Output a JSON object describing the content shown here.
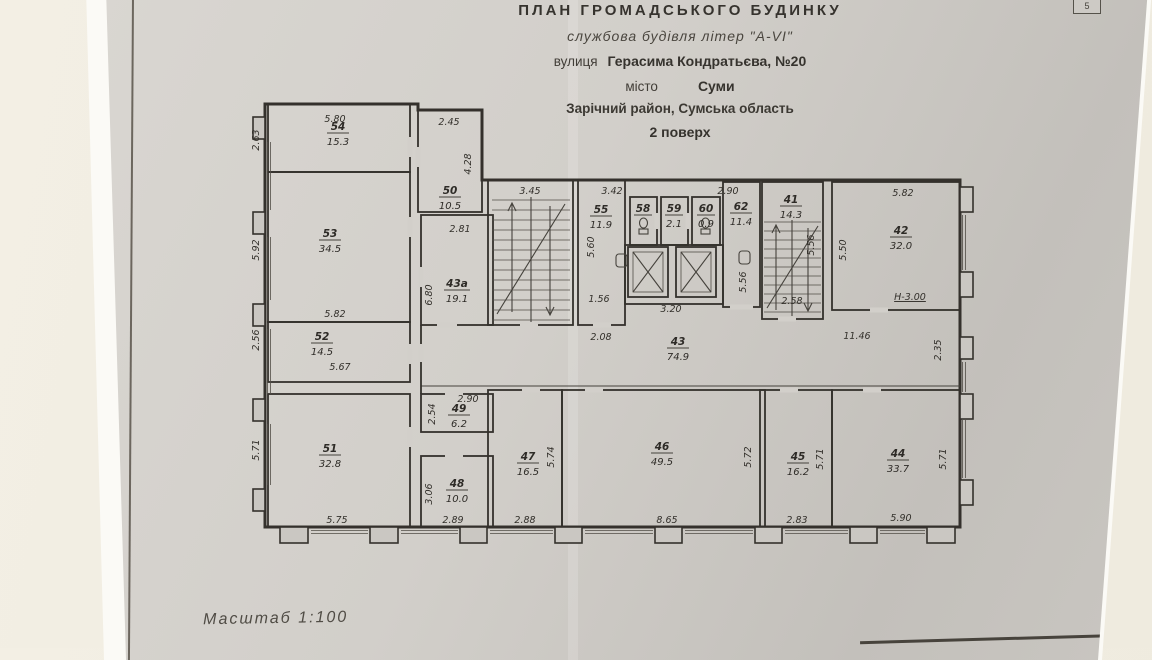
{
  "sheet": {
    "number": "5",
    "scale_label": "Масштаб  1:100"
  },
  "colors": {
    "paper": "#d2cfca",
    "ink": "#33302b",
    "desk_background": "#f1ede1"
  },
  "title_block": {
    "line1": "ПЛАН  ГРОМАДСЬКОГО  БУДИНКУ",
    "line2": "службова будівля літер \"А-VI\"",
    "street_prefix": "вулиця",
    "street_value": "Герасима Кондратьєва, №20",
    "city_prefix": "місто",
    "city_value": "Суми",
    "district": "Зарічний район, Сумська область",
    "floor": "2 поверх"
  },
  "rooms": {
    "r54": {
      "no": "54",
      "area": "15.3"
    },
    "r50": {
      "no": "50",
      "area": "10.5"
    },
    "r53": {
      "no": "53",
      "area": "34.5"
    },
    "r43a": {
      "no": "43а",
      "area": "19.1"
    },
    "r52": {
      "no": "52",
      "area": "14.5"
    },
    "r51": {
      "no": "51",
      "area": "32.8"
    },
    "r49": {
      "no": "49",
      "area": "6.2"
    },
    "r48": {
      "no": "48",
      "area": "10.0"
    },
    "r55": {
      "no": "55",
      "area": "11.9"
    },
    "r58": {
      "no": "58",
      "area": ""
    },
    "r59": {
      "no": "59",
      "area": "2.1"
    },
    "r60": {
      "no": "60",
      "area": "0.9"
    },
    "r62": {
      "no": "62",
      "area": "11.4"
    },
    "r41": {
      "no": "41",
      "area": "14.3"
    },
    "r42": {
      "no": "42",
      "area": "32.0"
    },
    "r43": {
      "no": "43",
      "area": "74.9"
    },
    "r47": {
      "no": "47",
      "area": "16.5"
    },
    "r46": {
      "no": "46",
      "area": "49.5"
    },
    "r45": {
      "no": "45",
      "area": "16.2"
    },
    "r44": {
      "no": "44",
      "area": "33.7"
    }
  },
  "dims": {
    "d54_w": "5.80",
    "d54_h": "2.63",
    "d50_w": "2.45",
    "d50_h": "4.28",
    "d53_h": "5.92",
    "d53_w": "5.82",
    "d43a_w": "2.81",
    "d43a_h": "6.80",
    "d52_h": "2.56",
    "d52_w": "5.67",
    "d51_h": "5.71",
    "d51_w": "5.75",
    "d49_w": "2.90",
    "d49_h": "2.54",
    "d48_h": "3.06",
    "d48_w": "2.89",
    "d_stairL": "3.45",
    "d55_w": "3.42",
    "d55_h": "5.60",
    "d55_b": "1.56",
    "d_208": "2.08",
    "d62_w": "2.90",
    "d62_h": "5.56",
    "d_lift": "3.20",
    "d41_h": "5.56",
    "d41_b": "2.58",
    "d42_w": "5.82",
    "d42_h": "5.50",
    "d42_mark": "Н-3.00",
    "d_1146": "11.46",
    "d_235": "2.35",
    "d47_h": "5.74",
    "d47_b": "2.88",
    "d46_h": "5.72",
    "d46_b": "8.65",
    "d45_h": "5.71",
    "d45_b": "2.83",
    "d44_h": "5.71",
    "d44_b": "5.90"
  }
}
